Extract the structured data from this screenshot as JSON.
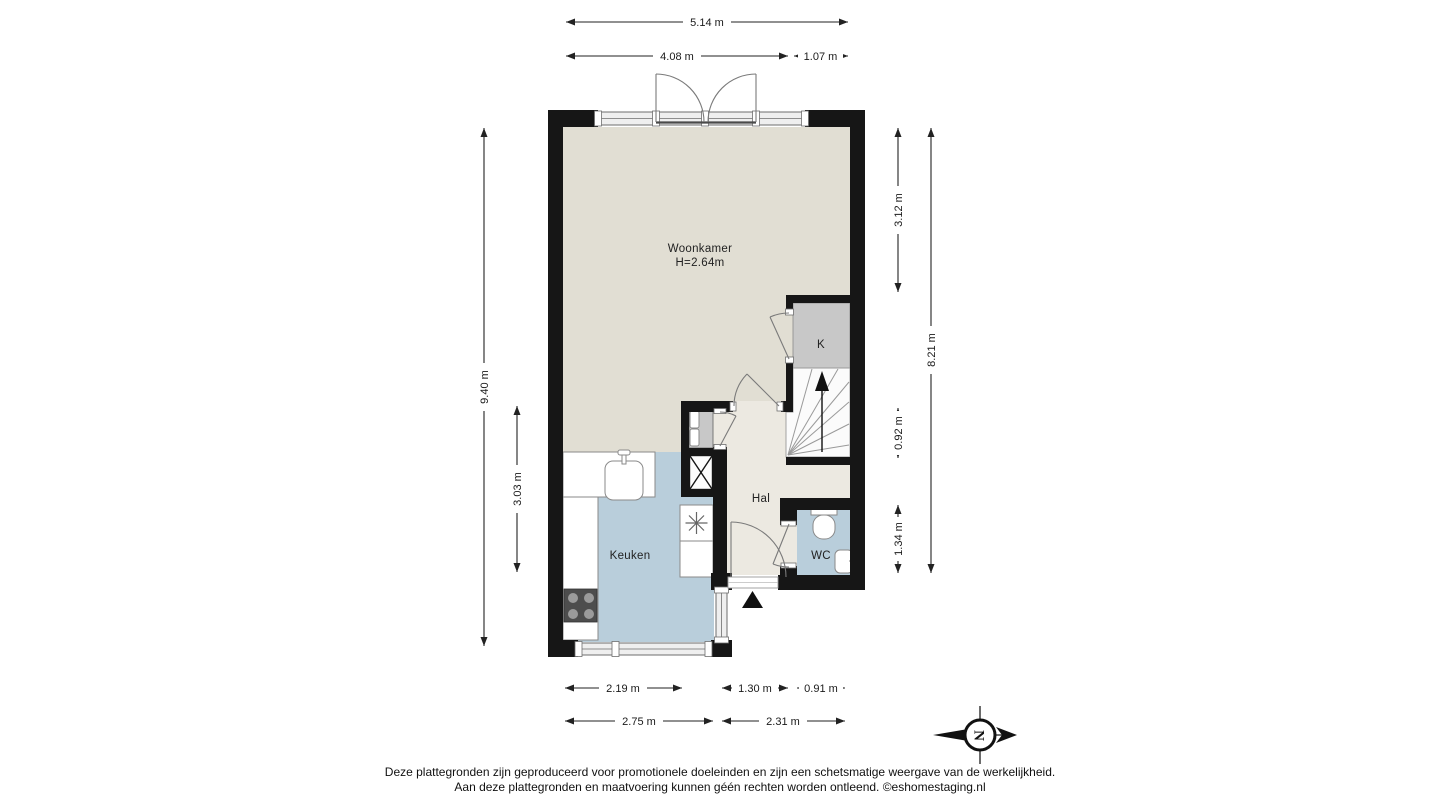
{
  "floorplan": {
    "rooms": {
      "woonkamer": {
        "name": "Woonkamer",
        "ceiling_height": "H=2.64m"
      },
      "keuken": {
        "name": "Keuken"
      },
      "hal": {
        "name": "Hal"
      },
      "wc": {
        "name": "WC"
      },
      "kast": {
        "name": "K"
      }
    },
    "dimensions": {
      "top": [
        "5.14 m",
        "4.08 m",
        "1.07 m"
      ],
      "left": [
        "9.40 m",
        "3.03 m"
      ],
      "right": [
        "3.12 m",
        "8.21 m",
        "0.92 m",
        "1.34 m"
      ],
      "bottom": [
        "2.19 m",
        "1.30 m",
        "0.91 m",
        "2.75 m",
        "2.31 m"
      ]
    },
    "compass": {
      "north_label": "N"
    },
    "colors": {
      "wall": "#161616",
      "living_floor": "#e1ded3",
      "hall_floor": "#ece9e1",
      "kitchen_floor": "#b9cedb",
      "wc_floor": "#b9cedb",
      "closet_floor": "#c8c8c8",
      "stairs_floor": "#fbfbfb"
    }
  },
  "footer": {
    "line1": "Deze plattegronden zijn geproduceerd voor promotionele doeleinden en zijn een schetsmatige weergave van de werkelijkheid.",
    "line2": "Aan deze plattegronden en maatvoering kunnen géén rechten worden ontleend. ©eshomestaging.nl"
  }
}
